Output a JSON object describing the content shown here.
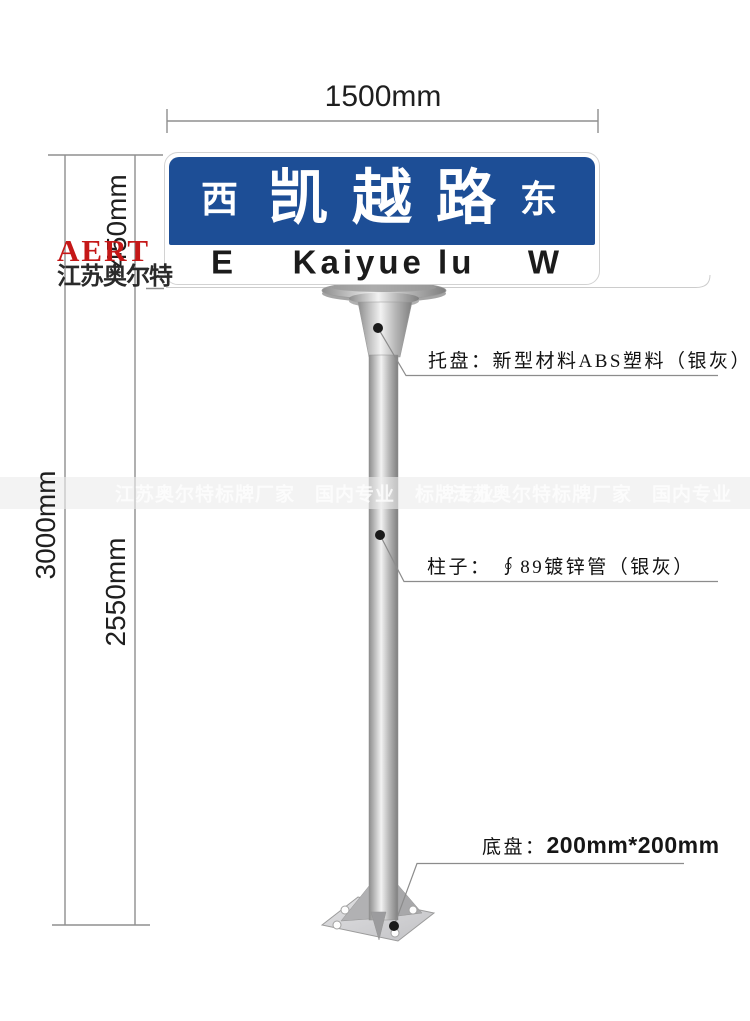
{
  "dimensions": {
    "width": "1500mm",
    "total_height": "3000mm",
    "sign_height": "450mm",
    "pole_height": "2550mm"
  },
  "sign": {
    "direction_left_cn": "西",
    "road_name_cn": "凯越路",
    "direction_right_cn": "东",
    "direction_left_en": "E",
    "road_name_en": "Kaiyue lu",
    "direction_right_en": "W",
    "panel_blue": "#1d4e96"
  },
  "logo": {
    "brand": "AERT",
    "company": "江苏奥尔特",
    "brand_color": "#c51818"
  },
  "watermark": {
    "left_text": "江苏奥尔特标牌厂家　国内专业　标牌专业",
    "right_text": "江苏奥尔特标牌厂家　国内专业　标牌专业"
  },
  "annotations": {
    "tray": "托盘：新型材料ABS塑料（银灰）",
    "pole": "柱子： ∮89镀锌管（银灰）",
    "base_label": "底盘：",
    "base_value": "200mm*200mm"
  }
}
